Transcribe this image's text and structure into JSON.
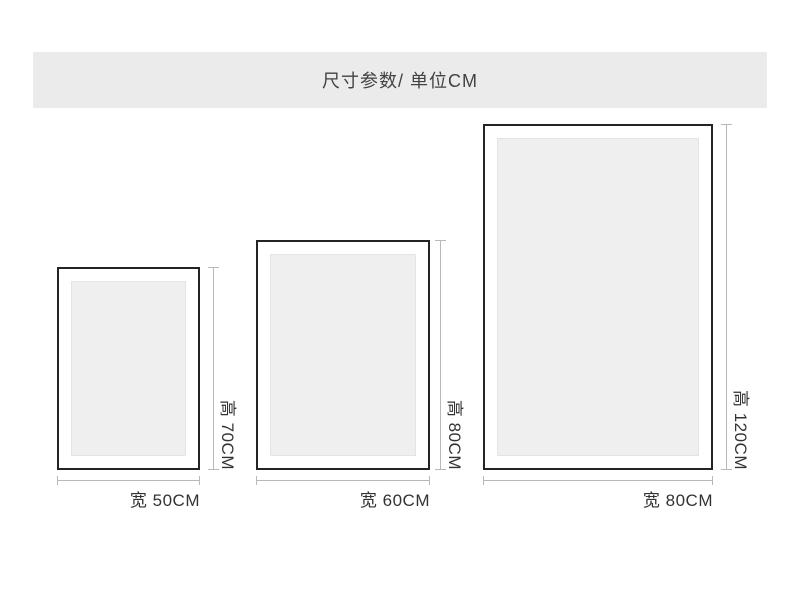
{
  "header": {
    "title": "尺寸参数/ 单位CM"
  },
  "unit": "CM",
  "frames": [
    {
      "width_cm": 50,
      "height_cm": 70,
      "width_label": "宽 50CM",
      "height_label": "高 70CM"
    },
    {
      "width_cm": 60,
      "height_cm": 80,
      "width_label": "宽 60CM",
      "height_label": "高 80CM"
    },
    {
      "width_cm": 80,
      "height_cm": 120,
      "width_label": "宽 80CM",
      "height_label": "高 120CM"
    }
  ],
  "colors": {
    "header_bg": "#ebebeb",
    "title_text": "#424242",
    "frame_border": "#242424",
    "artwork_fill": "#efefef",
    "artwork_border": "#e4e4e4",
    "dimension_line": "#b8b8b8",
    "label_text": "#333333"
  }
}
